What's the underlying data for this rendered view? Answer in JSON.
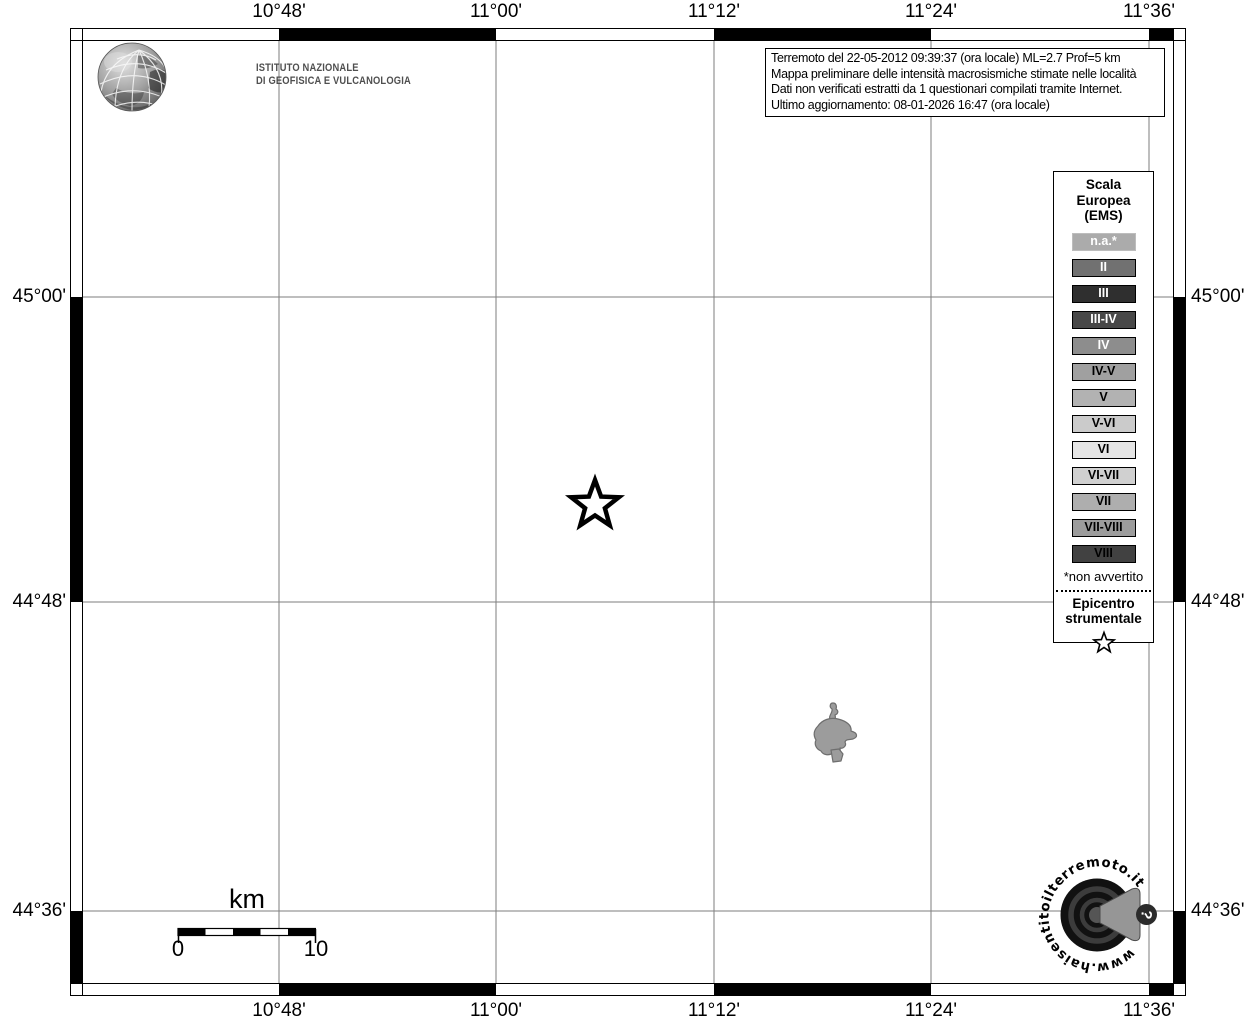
{
  "axis": {
    "lon": [
      "10°48'",
      "11°00'",
      "11°12'",
      "11°24'",
      "11°36'"
    ],
    "lat": [
      "45°00'",
      "44°48'",
      "44°36'"
    ]
  },
  "ingv": {
    "line1": "ISTITUTO NAZIONALE",
    "line2": "DI GEOFISICA E VULCANOLOGIA"
  },
  "info_box": {
    "lines": [
      "Terremoto del 22-05-2012 09:39:37 (ora locale) ML=2.7 Prof=5 km",
      "Mappa preliminare delle intensità macrosismiche stimate nelle località",
      "Dati non verificati estratti da 1 questionari compilati tramite Internet.",
      "Ultimo aggiornamento: 08-01-2026 16:47 (ora locale)"
    ]
  },
  "legend": {
    "title_lines": [
      "Scala",
      "Europea",
      "(EMS)"
    ],
    "items": [
      {
        "label": "n.a.*",
        "bg": "#ababab",
        "fg": "#ffffff",
        "border": "#bdbdbd"
      },
      {
        "label": "II",
        "bg": "#717171",
        "fg": "#ffffff",
        "border": "#000000"
      },
      {
        "label": "III",
        "bg": "#2f2f2f",
        "fg": "#ffffff",
        "border": "#000000"
      },
      {
        "label": "III-IV",
        "bg": "#484848",
        "fg": "#ffffff",
        "border": "#000000"
      },
      {
        "label": "IV",
        "bg": "#8d8d8d",
        "fg": "#ffffff",
        "border": "#000000"
      },
      {
        "label": "IV-V",
        "bg": "#a0a0a0",
        "fg": "#000000",
        "border": "#000000"
      },
      {
        "label": "V",
        "bg": "#b2b2b2",
        "fg": "#000000",
        "border": "#000000"
      },
      {
        "label": "V-VI",
        "bg": "#cbcbcb",
        "fg": "#000000",
        "border": "#000000"
      },
      {
        "label": "VI",
        "bg": "#e5e5e5",
        "fg": "#000000",
        "border": "#000000"
      },
      {
        "label": "VI-VII",
        "bg": "#d0d0d0",
        "fg": "#000000",
        "border": "#000000"
      },
      {
        "label": "VII",
        "bg": "#aeaeae",
        "fg": "#000000",
        "border": "#000000"
      },
      {
        "label": "VII-VIII",
        "bg": "#9c9c9c",
        "fg": "#000000",
        "border": "#000000"
      },
      {
        "label": "VIII",
        "bg": "#414141",
        "fg": "#000000",
        "border": "#000000"
      }
    ],
    "footnote": "*non avvertito",
    "epicenter_lines": [
      "Epicentro",
      "strumentale"
    ]
  },
  "scale_bar": {
    "unit": "km",
    "start": "0",
    "end": "10"
  },
  "watermark": {
    "text": "www.haisentitoilterremoto.it",
    "question": "?"
  }
}
